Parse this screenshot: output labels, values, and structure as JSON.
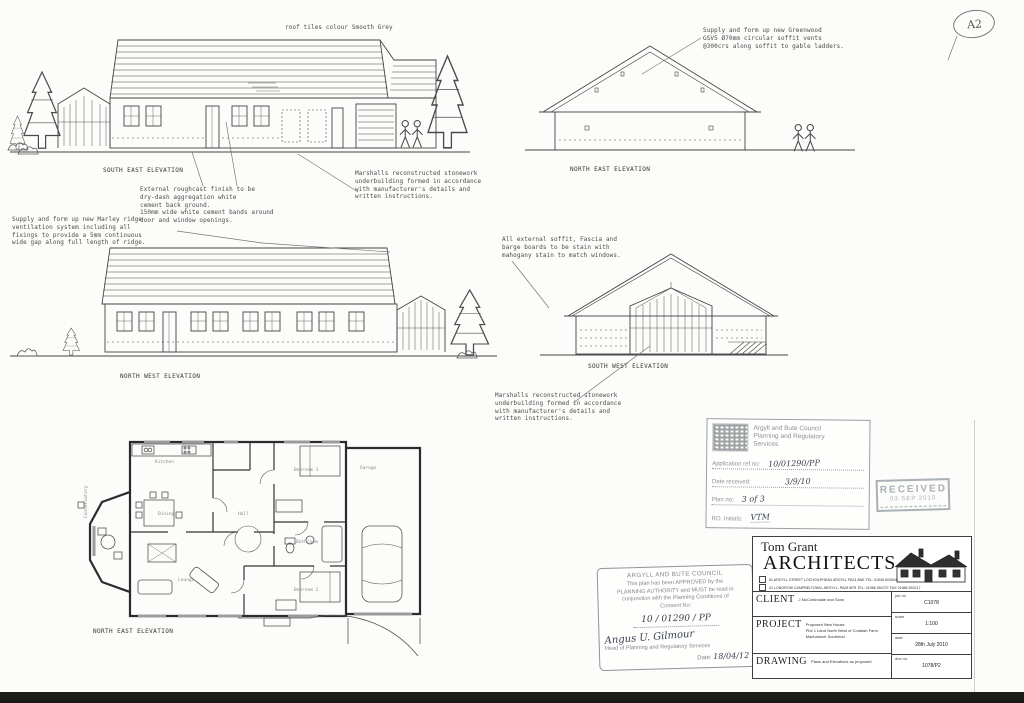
{
  "sheet": {
    "page_ref": "A2",
    "roof_note": "roof tiles colour Smooth Grey"
  },
  "notes": {
    "greenwood": "Supply and form up new Greenwood\nGSV5 Ø70mm circular soffit vents\n@300crs along soffit to gable ladders.",
    "marley": "Supply and form up new Marley ridge\nventilation system including all\nfixings to provide a 5mm continuous\nwide gap along full length of ridge.",
    "roughcast": "External roughcast finish to be\ndry-dash aggregation white\ncement back ground.\n150mm wide white cement bands around\ndoor and window openings.",
    "stonework_a": "Marshalls reconstructed stonework\nunderbuilding formed in accordance\nwith manufacturer's details and\nwritten instructions.",
    "stain": "All external soffit, Fascia and\nbarge boards to be stain with\nmahogany stain to match windows.",
    "stonework_b": "Marshalls reconstructed stonework\nunderbuilding formed in accordance\nwith manufacturer's details and\nwritten instructions."
  },
  "labels": {
    "south_east": "SOUTH EAST ELEVATION",
    "north_east": "NORTH EAST ELEVATION",
    "north_west": "NORTH WEST ELEVATION",
    "south_west": "SOUTH WEST ELEVATION",
    "floor_plan": "NORTH EAST ELEVATION"
  },
  "plan": {
    "rooms": {
      "kitchen": "Kitchen",
      "dining": "Dining",
      "lounge": "Lounge",
      "hall": "Hall",
      "bathroom": "Bathroom",
      "bedroom1": "Bedroom 1",
      "bedroom2": "Bedroom 2",
      "garage": "Garage",
      "conservatory": "Conservatory"
    }
  },
  "planning_stamp": {
    "authority": "Argyll and Bute Council\nPlanning and Regulatory\nServices",
    "fields": [
      {
        "label": "Application ref no:",
        "value": "10/01290/PP"
      },
      {
        "label": "Date received:",
        "value": "3/9/10"
      },
      {
        "label": "Plan no:",
        "value": "3 of 3"
      },
      {
        "label": "RO. Initials:",
        "value": "VTM"
      }
    ]
  },
  "received_stamp": {
    "line1": "RECEIVED",
    "line2": "03 SEP 2010"
  },
  "approval_stamp": {
    "title": "ARGYLL AND BUTE COUNCIL",
    "body": "This plan has been APPROVED by the\nPLANNING AUTHORITY and MUST be read in\nconjunction with the Planning Conditions of\nConsent No:",
    "consent_no": "10 / 01290 / PP",
    "signature": "Angus U. Gilmour",
    "signatory": "Head of Planning and Regulatory Services",
    "date_label": "Date:",
    "date_value": "18/04/12"
  },
  "title_block": {
    "firm_line1": "Tom Grant",
    "firm_line2": "ARCHITECTS",
    "address1": "51 ARGYLL STREET LOCHGILPHEAD ARGYLL PA31 8NE   TEL: 01546 602844",
    "address2": "41 LONGROW CAMPBELTOWN, ARGYLL, PA28 6ER   TEL: 01586 554727 FAX 01586 553217",
    "client_label": "CLIENT",
    "client_value": "J McCorkindale and Sons",
    "project_label": "PROJECT",
    "project_value": "Proposed New House\nPlot 1 Land North West of Contash Farm\nMacharioch Southend",
    "drawing_label": "DRAWING",
    "drawing_value": "Plans and Elevations as proposed",
    "job_label": "job no",
    "job_value": "C1078",
    "scale_label": "scale",
    "scale_value": "1:100",
    "date_label": "date",
    "date_value": "28th July 2010",
    "drw_label": "drw no.",
    "drw_value": "1078/P2"
  }
}
